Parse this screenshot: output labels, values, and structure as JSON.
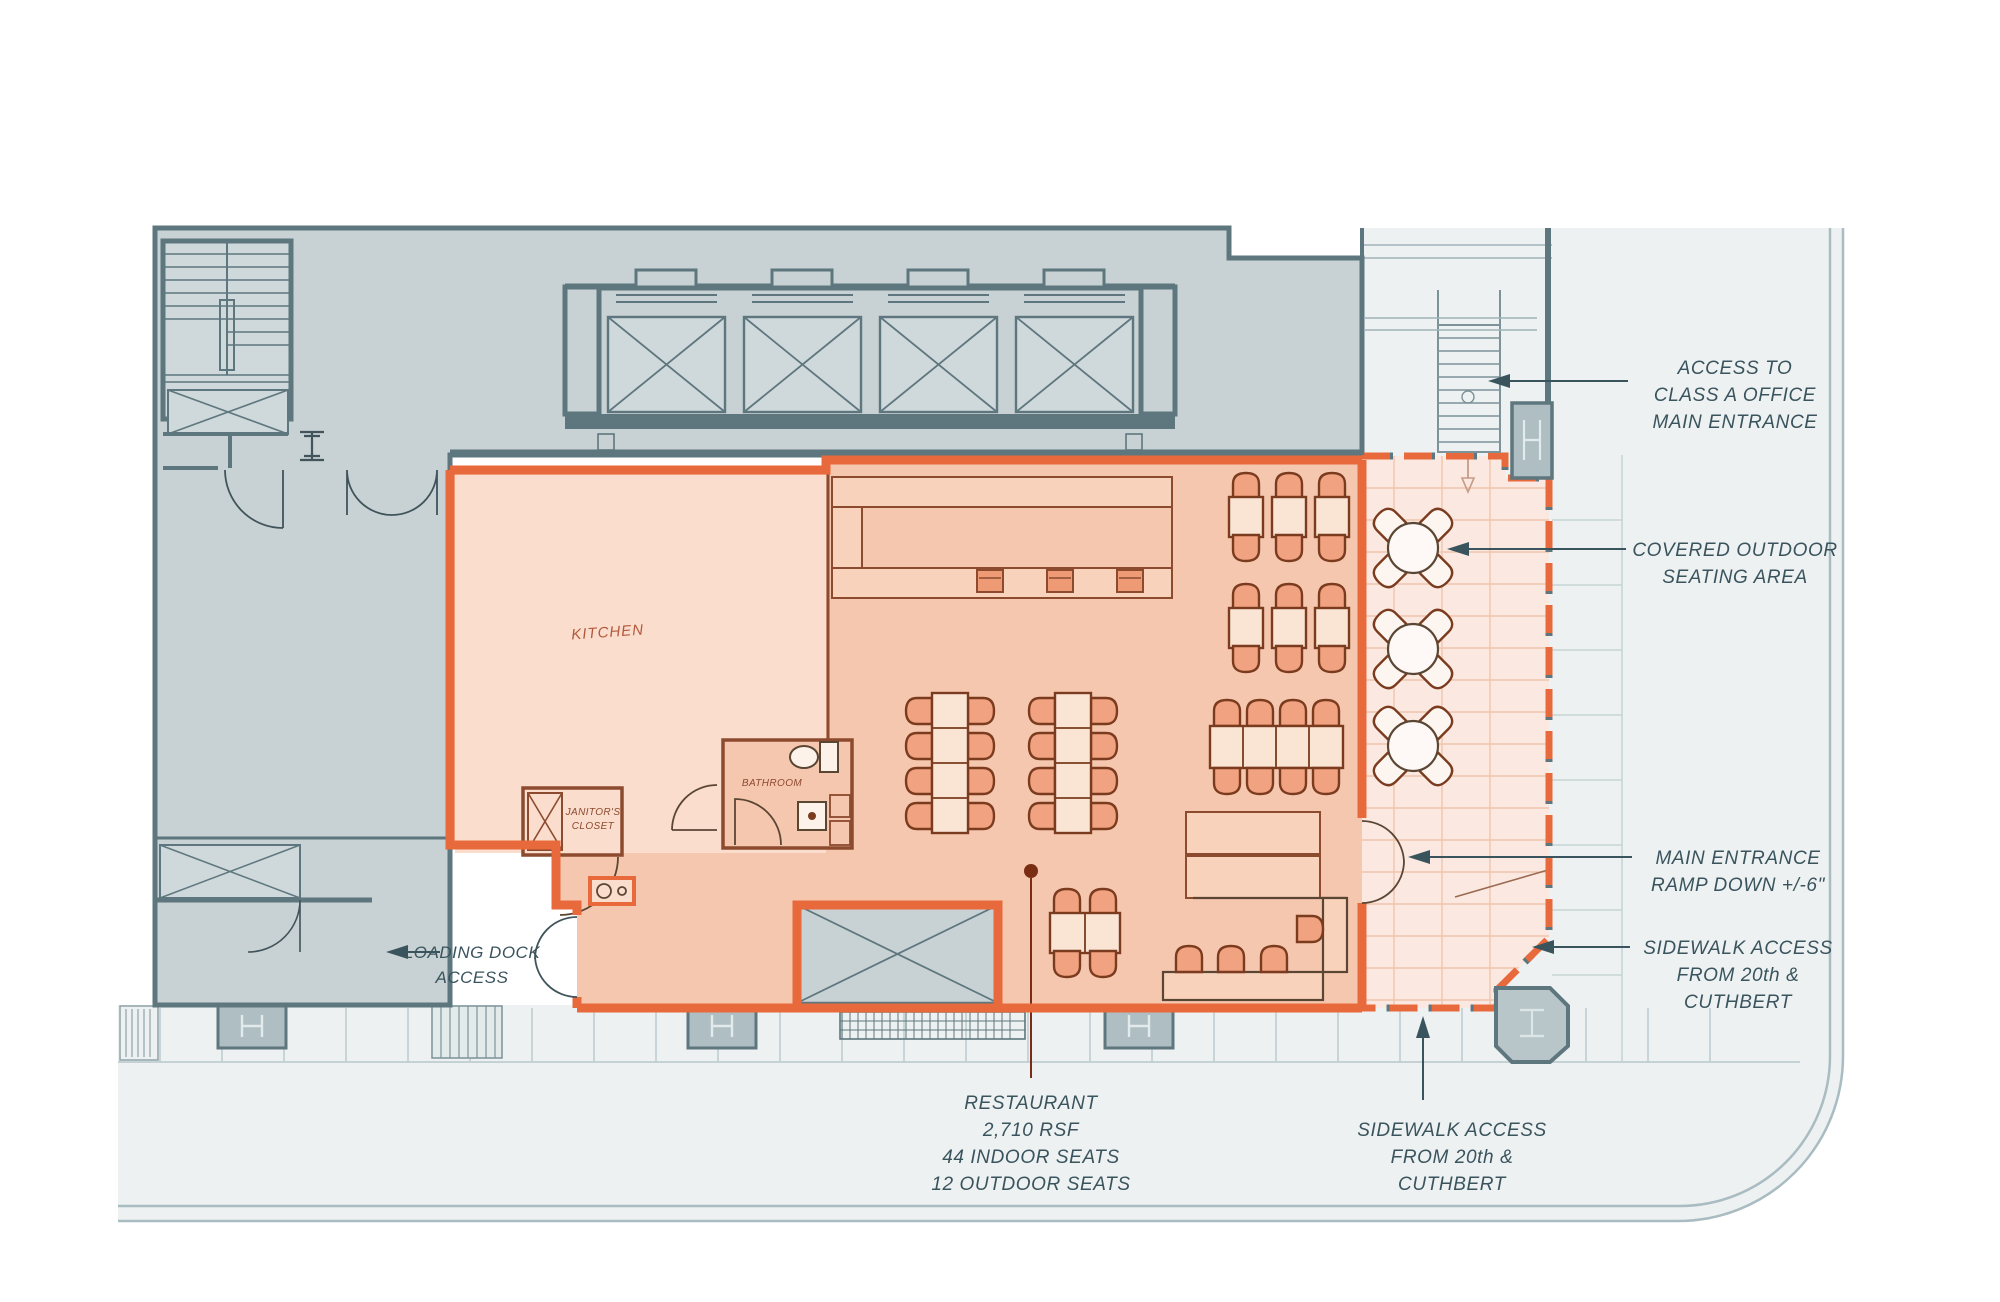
{
  "plan": {
    "labels": {
      "kitchen": "KITCHEN",
      "bathroom": "BATHROOM",
      "janitors_line1": "JANITOR'S",
      "janitors_line2": "CLOSET"
    },
    "stats": {
      "lines": [
        "RESTAURANT",
        "2,710 RSF",
        "44 INDOOR SEATS",
        "12 OUTDOOR SEATS"
      ]
    },
    "annotations": {
      "access_office": {
        "lines": [
          "ACCESS TO",
          "CLASS A OFFICE",
          "MAIN ENTRANCE"
        ]
      },
      "covered_outdoor": {
        "lines": [
          "COVERED OUTDOOR",
          "SEATING AREA"
        ]
      },
      "main_entrance": {
        "lines": [
          "MAIN ENTRANCE",
          "RAMP DOWN +/-6\""
        ]
      },
      "sidewalk_right": {
        "lines": [
          "SIDEWALK ACCESS",
          "FROM 20th &",
          "CUTHBERT"
        ]
      },
      "sidewalk_bottom": {
        "lines": [
          "SIDEWALK ACCESS",
          "FROM 20th &",
          "CUTHBERT"
        ]
      },
      "loading_dock": {
        "lines": [
          "LOADING DOCK",
          "ACCESS"
        ]
      }
    },
    "colors": {
      "lease_orange": "#E8693B",
      "wall_slate": "#5E777E",
      "building_fill": "#C8D1D3",
      "dining_fill": "#F6C7AF",
      "kitchen_fill": "#FADDCC",
      "outdoor_fill": "#FBE9E1",
      "sidewalk_fill": "#EDF1F1",
      "chair_fill": "#F1A280",
      "table_fill": "#FAE5D4",
      "furniture_stroke": "#7A3B1E",
      "annotation_text": "#3A545E",
      "kitchen_label": "#B2593B"
    }
  }
}
